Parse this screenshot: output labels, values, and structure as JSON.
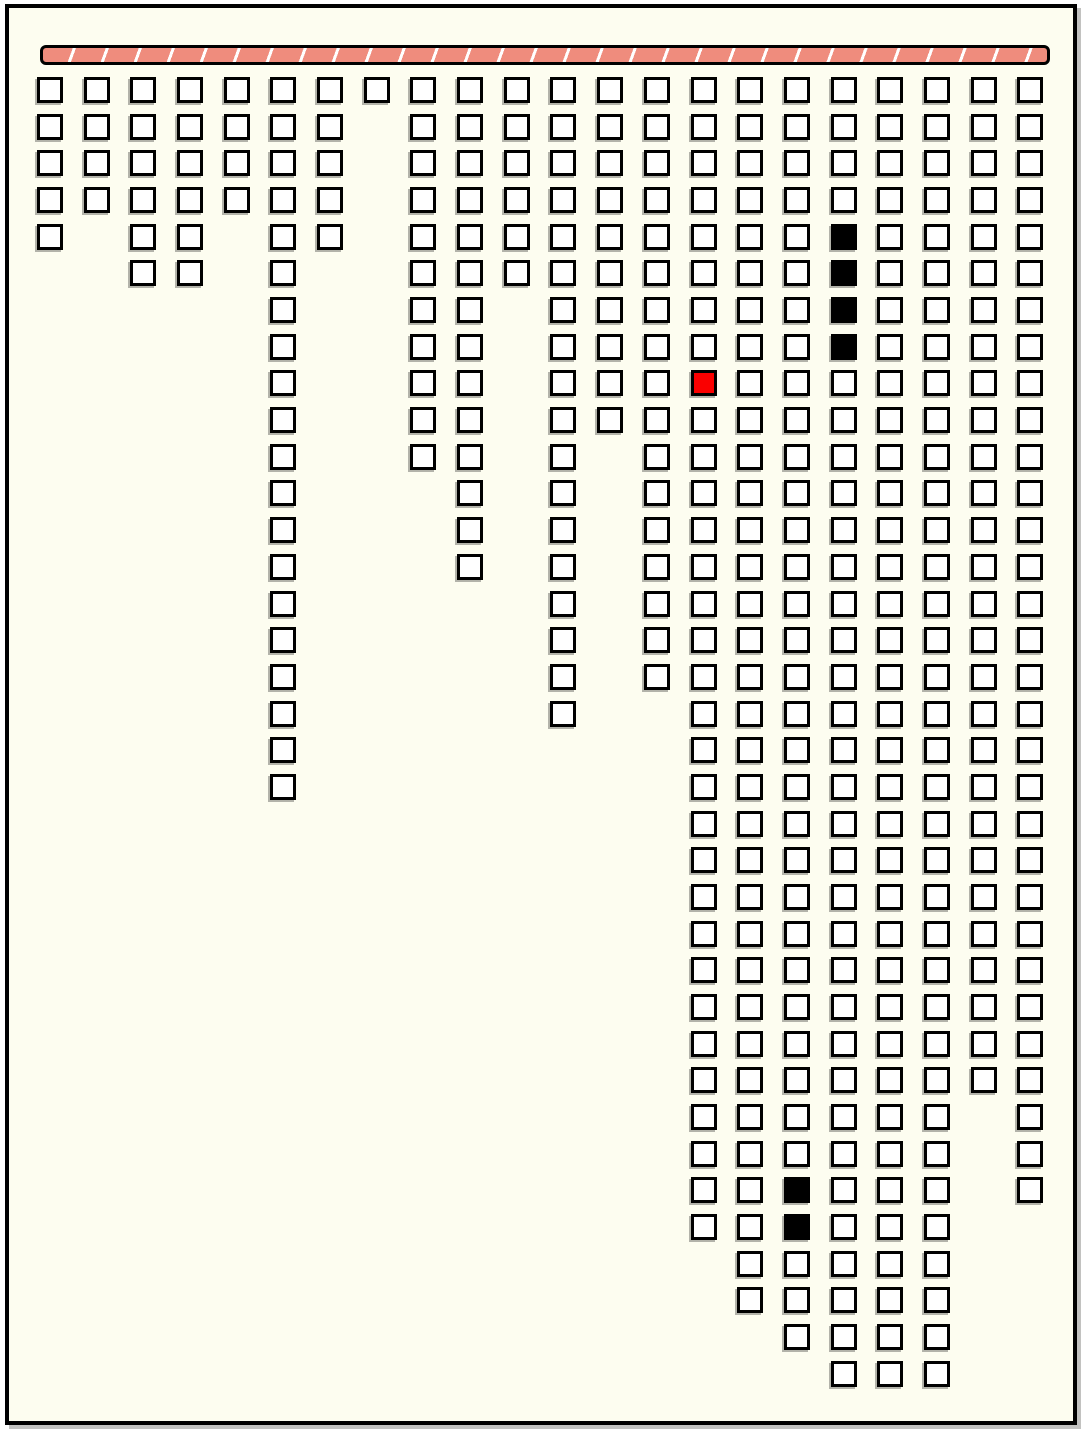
{
  "colors": {
    "page_background": "#ffffff",
    "frame_background": "#fdfdf0",
    "frame_border": "#000000",
    "bar_fill": "#ef8c7d",
    "bar_stripe": "#ffffff",
    "bar_border": "#000000",
    "cell_fill": "#ffffff",
    "cell_border": "#000000",
    "cell_filled_black": "#000000",
    "cell_filled_red": "#fa0000",
    "cell_shadow": "#69695f"
  },
  "chart_data": {
    "type": "bar",
    "subtype": "icicle-grid-of-squares",
    "orientation": "columns-hanging-from-top-bar",
    "title": "",
    "xlabel": "",
    "ylabel": "",
    "unit": "squares",
    "columns": 22,
    "max_rows": 36,
    "categories": [
      "col-1",
      "col-2",
      "col-3",
      "col-4",
      "col-5",
      "col-6",
      "col-7",
      "col-8",
      "col-9",
      "col-10",
      "col-11",
      "col-12",
      "col-13",
      "col-14",
      "col-15",
      "col-16",
      "col-17",
      "col-18",
      "col-19",
      "col-20",
      "col-21",
      "col-22"
    ],
    "values": [
      5,
      4,
      6,
      6,
      4,
      20,
      5,
      1,
      11,
      14,
      6,
      18,
      10,
      17,
      32,
      34,
      35,
      36,
      36,
      36,
      28,
      31
    ],
    "marked_cells": [
      {
        "column": 15,
        "row": 9,
        "color": "red"
      },
      {
        "column": 17,
        "row": 31,
        "color": "black"
      },
      {
        "column": 17,
        "row": 32,
        "color": "black"
      },
      {
        "column": 18,
        "row": 5,
        "color": "black"
      },
      {
        "column": 18,
        "row": 6,
        "color": "black"
      },
      {
        "column": 18,
        "row": 7,
        "color": "black"
      },
      {
        "column": 18,
        "row": 8,
        "color": "black"
      }
    ],
    "legend": [],
    "grid_on": false
  }
}
